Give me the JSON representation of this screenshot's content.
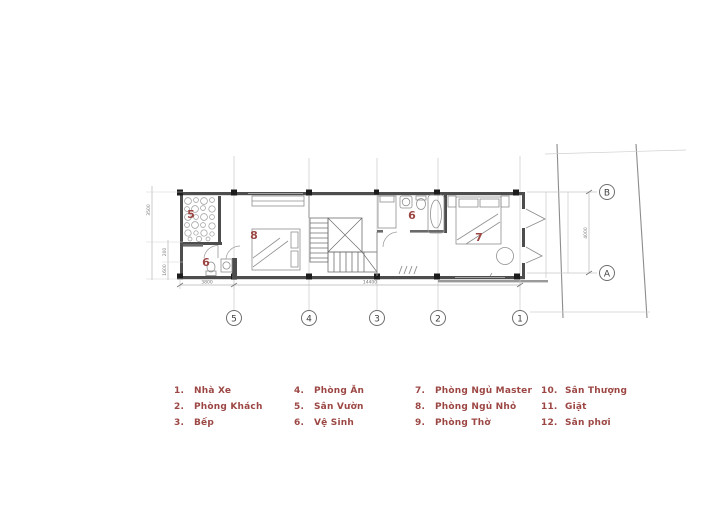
{
  "colors": {
    "accent": "#9c4744",
    "wall": "#4d4d4d",
    "furniture_line": "#8f8f8f",
    "grid_line": "#c8c8c8"
  },
  "plan": {
    "room_labels": {
      "garden": "5",
      "bedroom_small": "8",
      "bath_lower": "6",
      "bath_upper": "6",
      "master_bedroom": "7"
    },
    "grid": {
      "columns": [
        "5",
        "4",
        "3",
        "2",
        "1"
      ],
      "rows": [
        "B",
        "A"
      ]
    },
    "dimensions": {
      "bottom_left": "3800",
      "bottom_right": "14400",
      "left_outer": "3500",
      "left_seg1": "200",
      "left_seg2": "1600",
      "right_ab": "4000"
    }
  },
  "legend": {
    "items": [
      {
        "num": "1.",
        "label": "Nhà Xe"
      },
      {
        "num": "2.",
        "label": "Phòng Khách"
      },
      {
        "num": "3.",
        "label": "Bếp"
      },
      {
        "num": "4.",
        "label": "Phòng Ăn"
      },
      {
        "num": "5.",
        "label": "Sân Vườn"
      },
      {
        "num": "6.",
        "label": "Vệ Sinh"
      },
      {
        "num": "7.",
        "label": "Phòng Ngủ Master"
      },
      {
        "num": "8.",
        "label": "Phòng Ngủ Nhỏ"
      },
      {
        "num": "9.",
        "label": "Phòng Thờ"
      },
      {
        "num": "10.",
        "label": "Sân Thượng"
      },
      {
        "num": "11.",
        "label": "Giặt"
      },
      {
        "num": "12.",
        "label": "Sân phơi"
      }
    ]
  }
}
